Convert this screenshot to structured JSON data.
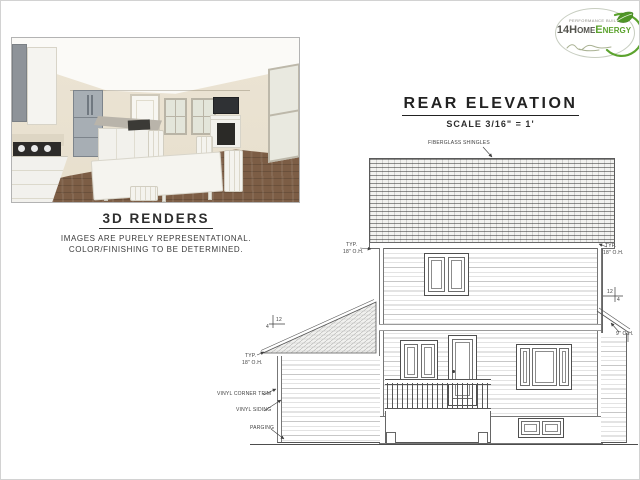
{
  "logo": {
    "tagline": "PERFORMANCE BUILT",
    "brand_prefix": "14Home",
    "brand_suffix": "Energy",
    "colors": {
      "brand_dark": "#53534d",
      "brand_green": "#5ca32e",
      "ring": "#c7cdc0"
    }
  },
  "renders_section": {
    "title": "3D RENDERS",
    "caption_line1": "IMAGES ARE PURELY REPRESENTATIONAL.",
    "caption_line2": "COLOR/FINISHING TO BE DETERMINED."
  },
  "elevation_section": {
    "title": "REAR ELEVATION",
    "scale_note": "SCALE 3/16\" = 1'",
    "annotations": {
      "shingles": "FIBERGLASS SHINGLES",
      "typ": "TYP.",
      "overhang_18": "18\" O.H.",
      "overhang_9": "9\" O.H.",
      "corner_trim": "VINYL CORNER TRIM",
      "siding": "VINYL SIDING",
      "parging": "PARGING",
      "pitch_run": "12",
      "pitch_rise": "4"
    }
  }
}
